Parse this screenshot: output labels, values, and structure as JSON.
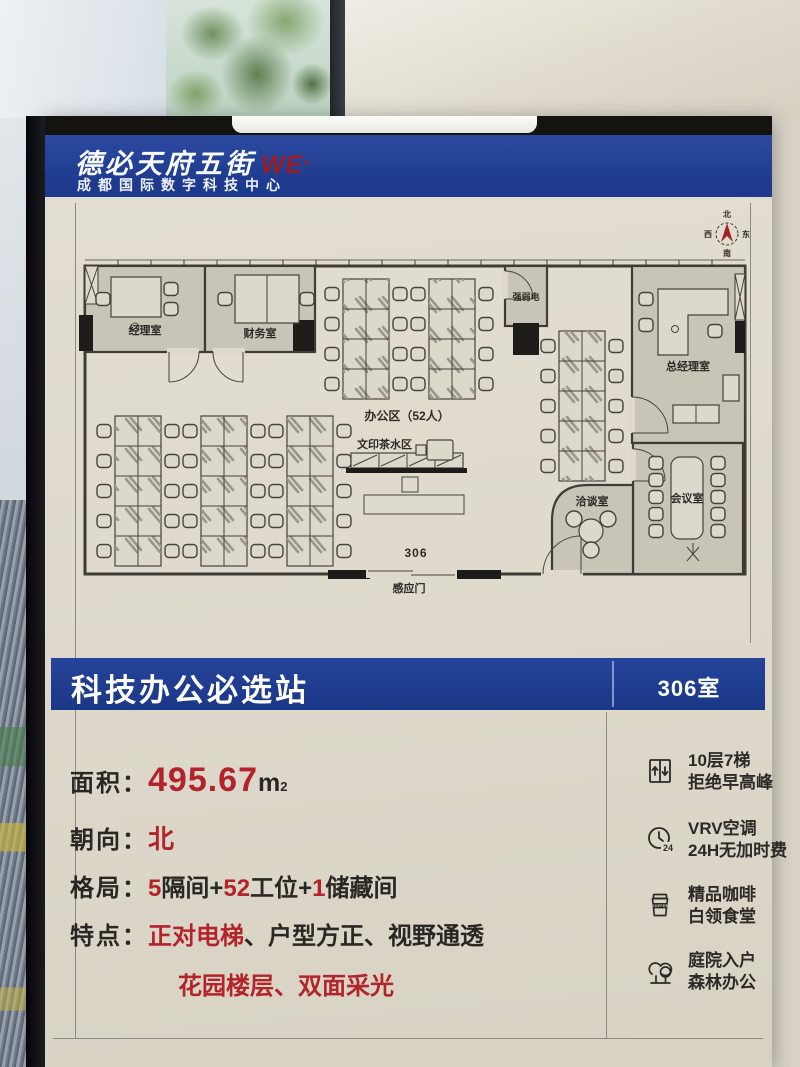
{
  "header": {
    "brand": "德必天府五街",
    "logo_we": "WE",
    "logo_plus": "+",
    "subtitle": "成都国际数字科技中心"
  },
  "plan": {
    "compass": {
      "n": "北",
      "e": "东",
      "s": "南",
      "w": "西"
    },
    "rooms": {
      "manager": "经理室",
      "finance": "财务室",
      "office_area": "办公区（52人）",
      "utility": "强弱电",
      "gm": "总经理室",
      "meeting": "会议室",
      "negotiation": "洽谈室",
      "print_tea": "文印茶水区",
      "room_no": "306",
      "sensor_door": "感应门"
    }
  },
  "banner": {
    "title": "科技办公必选站",
    "room": "306室"
  },
  "specs": {
    "area_label": "面积：",
    "area_value": "495.67",
    "area_unit": "m",
    "area_sup": "2",
    "facing_label": "朝向：",
    "facing_value": "北",
    "layout_label": "格局：",
    "layout_n1": "5",
    "layout_t1": "隔间+",
    "layout_n2": "52",
    "layout_t2": "工位+",
    "layout_n3": "1",
    "layout_t3": "储藏间",
    "features_label": "特点：",
    "feature_red": "正对电梯",
    "feature_rest": "、户型方正、视野通透",
    "feature_line2": "花园楼层、双面采光"
  },
  "amenities": [
    {
      "icon": "elevator-icon",
      "line1": "10层7梯",
      "line2": "拒绝早高峰"
    },
    {
      "icon": "clock-24-icon",
      "line1": "VRV空调",
      "line2": "24H无加时费"
    },
    {
      "icon": "coffee-icon",
      "line1": "精品咖啡",
      "line2": "白领食堂"
    },
    {
      "icon": "trees-icon",
      "line1": "庭院入户",
      "line2": "森林办公"
    }
  ],
  "colors": {
    "brand_blue": "#1e3c90",
    "accent_red": "#b2232a",
    "poster_cream": "#ded9cc"
  }
}
